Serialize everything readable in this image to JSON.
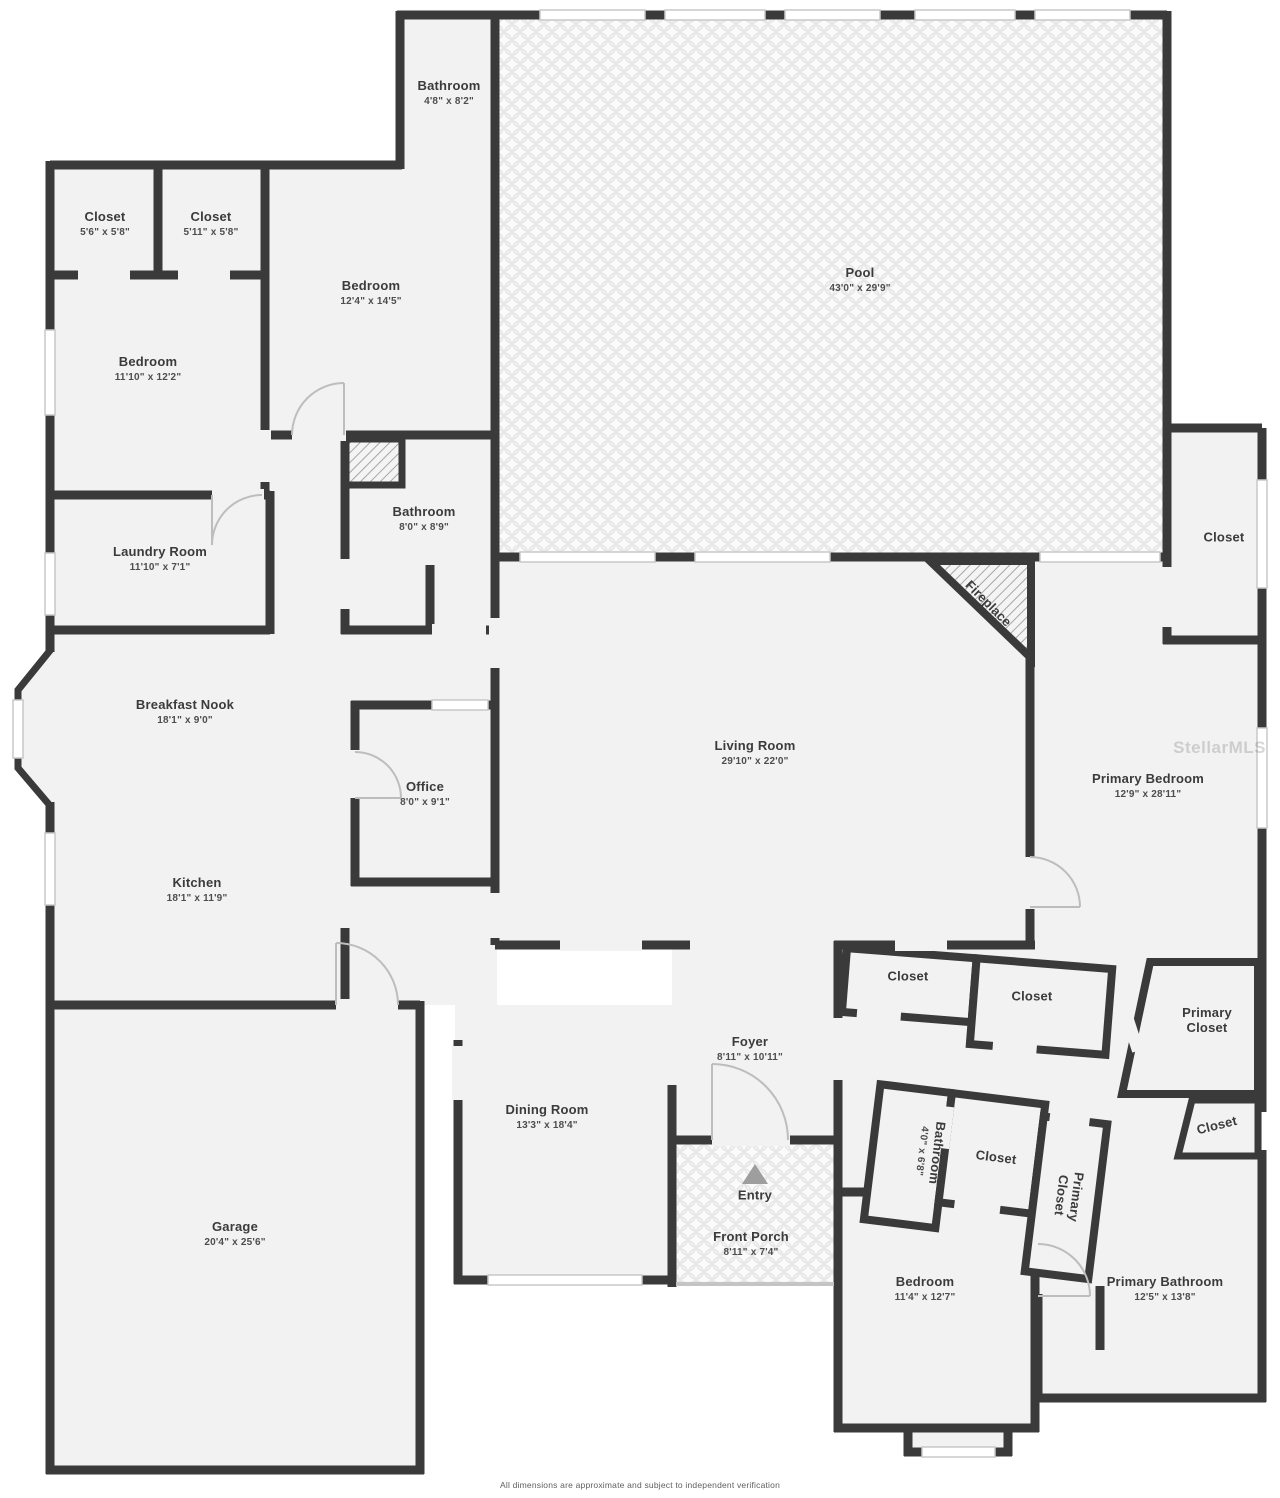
{
  "page": {
    "wall_color": "#3a3a3a",
    "floor_color": "#f2f2f2",
    "label_color": "#3b3b3b",
    "watermark": "StellarMLS",
    "disclaimer": "All dimensions are approximate and subject to independent verification"
  },
  "rooms": [
    {
      "id": "pool-bathroom",
      "name": "Bathroom",
      "dims": "4'8\" x 8'2\"",
      "x": 449,
      "y": 93,
      "rot": 0
    },
    {
      "id": "closet-1",
      "name": "Closet",
      "dims": "5'6\" x 5'8\"",
      "x": 105,
      "y": 224,
      "rot": 0
    },
    {
      "id": "closet-2",
      "name": "Closet",
      "dims": "5'11\" x 5'8\"",
      "x": 211,
      "y": 224,
      "rot": 0
    },
    {
      "id": "bedroom-2",
      "name": "Bedroom",
      "dims": "12'4\" x 14'5\"",
      "x": 371,
      "y": 293,
      "rot": 0
    },
    {
      "id": "bedroom-1",
      "name": "Bedroom",
      "dims": "11'10\" x 12'2\"",
      "x": 148,
      "y": 369,
      "rot": 0
    },
    {
      "id": "pool",
      "name": "Pool",
      "dims": "43'0\" x 29'9\"",
      "x": 860,
      "y": 280,
      "rot": 0
    },
    {
      "id": "bathroom-2",
      "name": "Bathroom",
      "dims": "8'0\" x 8'9\"",
      "x": 424,
      "y": 519,
      "rot": 0
    },
    {
      "id": "laundry-room",
      "name": "Laundry Room",
      "dims": "11'10\" x 7'1\"",
      "x": 160,
      "y": 559,
      "rot": 0
    },
    {
      "id": "pool-closet",
      "name": "Closet",
      "dims": null,
      "x": 1224,
      "y": 538,
      "rot": 0
    },
    {
      "id": "breakfast-nook",
      "name": "Breakfast Nook",
      "dims": "18'1\" x 9'0\"",
      "x": 185,
      "y": 712,
      "rot": 0
    },
    {
      "id": "office",
      "name": "Office",
      "dims": "8'0\" x 9'1\"",
      "x": 425,
      "y": 794,
      "rot": 0
    },
    {
      "id": "kitchen",
      "name": "Kitchen",
      "dims": "18'1\" x 11'9\"",
      "x": 197,
      "y": 890,
      "rot": 0
    },
    {
      "id": "living-room",
      "name": "Living Room",
      "dims": "29'10\" x 22'0\"",
      "x": 755,
      "y": 753,
      "rot": 0
    },
    {
      "id": "fireplace",
      "name": "Fireplace",
      "dims": null,
      "x": 988,
      "y": 604,
      "rot": 45
    },
    {
      "id": "primary-bedroom",
      "name": "Primary Bedroom",
      "dims": "12'9\" x 28'11\"",
      "x": 1148,
      "y": 786,
      "rot": 0
    },
    {
      "id": "closet-a",
      "name": "Closet",
      "dims": null,
      "x": 908,
      "y": 977,
      "rot": 0
    },
    {
      "id": "closet-b",
      "name": "Closet",
      "dims": null,
      "x": 1032,
      "y": 997,
      "rot": 0
    },
    {
      "id": "primary-closet-1",
      "name": "Primary Closet",
      "dims": null,
      "x": 1207,
      "y": 1021,
      "rot": 0,
      "stack": true
    },
    {
      "id": "closet-c",
      "name": "Closet",
      "dims": null,
      "x": 1217,
      "y": 1126,
      "rot": -14
    },
    {
      "id": "foyer",
      "name": "Foyer",
      "dims": "8'11\" x 10'11\"",
      "x": 750,
      "y": 1049,
      "rot": 0
    },
    {
      "id": "dining-room",
      "name": "Dining Room",
      "dims": "13'3\" x 18'4\"",
      "x": 547,
      "y": 1117,
      "rot": 0
    },
    {
      "id": "bathroom-3",
      "name": "Bathroom",
      "dims": "4'0\" x 6'8\"",
      "x": 930,
      "y": 1152,
      "rot": 97
    },
    {
      "id": "closet-d",
      "name": "Closet",
      "dims": null,
      "x": 996,
      "y": 1158,
      "rot": 7
    },
    {
      "id": "primary-closet-2",
      "name": "Primary Closet",
      "dims": null,
      "x": 1068,
      "y": 1196,
      "rot": 97,
      "stack": true
    },
    {
      "id": "entry",
      "name": "Entry",
      "dims": null,
      "x": 755,
      "y": 1196,
      "rot": 0
    },
    {
      "id": "front-porch",
      "name": "Front Porch",
      "dims": "8'11\" x 7'4\"",
      "x": 751,
      "y": 1244,
      "rot": 0
    },
    {
      "id": "bedroom-3",
      "name": "Bedroom",
      "dims": "11'4\" x 12'7\"",
      "x": 925,
      "y": 1289,
      "rot": 0
    },
    {
      "id": "primary-bathroom",
      "name": "Primary Bathroom",
      "dims": "12'5\" x 13'8\"",
      "x": 1165,
      "y": 1289,
      "rot": 0
    },
    {
      "id": "garage",
      "name": "Garage",
      "dims": "20'4\" x 25'6\"",
      "x": 235,
      "y": 1234,
      "rot": 0
    }
  ]
}
